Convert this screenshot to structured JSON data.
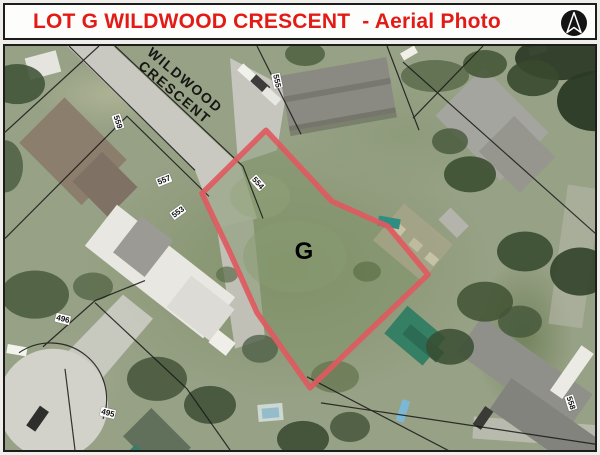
{
  "header": {
    "title": "LOT G WILDWOOD CRESCENT  - Aerial Photo",
    "title_color": "#e31b17"
  },
  "map": {
    "street_label_line1": "WILDWOOD",
    "street_label_line2": "CRESCENT",
    "lot_letter": "G",
    "outline_color": "#de5a60",
    "parcel_labels": [
      {
        "text": "559"
      },
      {
        "text": "557"
      },
      {
        "text": "555"
      },
      {
        "text": "554"
      },
      {
        "text": "553"
      },
      {
        "text": "496"
      },
      {
        "text": "495"
      },
      {
        "text": "558"
      }
    ]
  }
}
